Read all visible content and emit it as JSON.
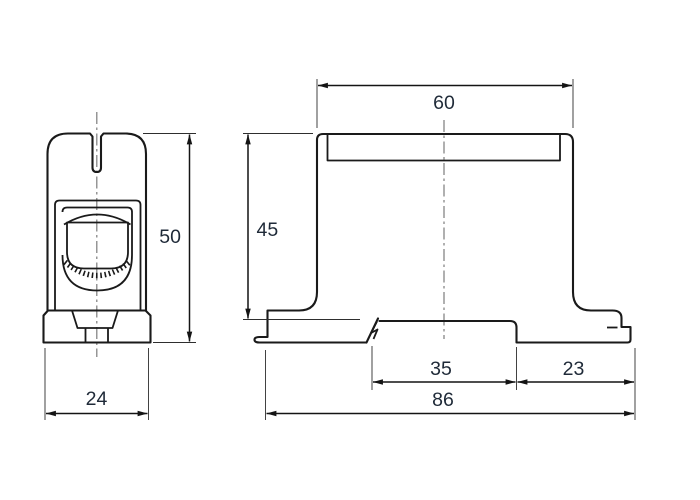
{
  "colors": {
    "line": "#1a1a1a",
    "dimension_text": "#1f2a38",
    "centerline": "#7c7c7c",
    "background": "#ffffff"
  },
  "side_view": {
    "width": "24",
    "height": "50"
  },
  "front_view": {
    "top_width": "60",
    "body_height": "45",
    "rail_recess_width": "35",
    "right_foot_width": "23",
    "overall_width": "86"
  }
}
